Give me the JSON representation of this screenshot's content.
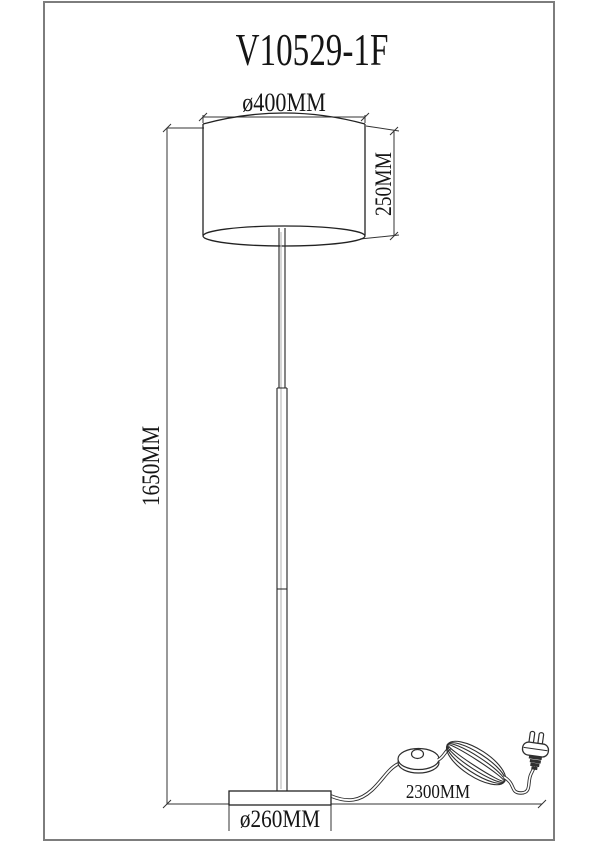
{
  "page": {
    "background": "#ffffff",
    "frame_color": "#7d7d7d",
    "line_color": "#222222"
  },
  "labels": {
    "title": "V10529-1F",
    "shade_diameter": "ø400MM",
    "shade_height": "250MM",
    "lamp_height": "1650MM",
    "base_diameter": "ø260MM",
    "cord_length": "2300MM"
  },
  "drawing": {
    "type": "technical line drawing, front elevation of a floor lamp",
    "parts": [
      "lamp shade",
      "pole",
      "round base",
      "power cord",
      "foot switch",
      "cord coil",
      "power plug"
    ]
  }
}
